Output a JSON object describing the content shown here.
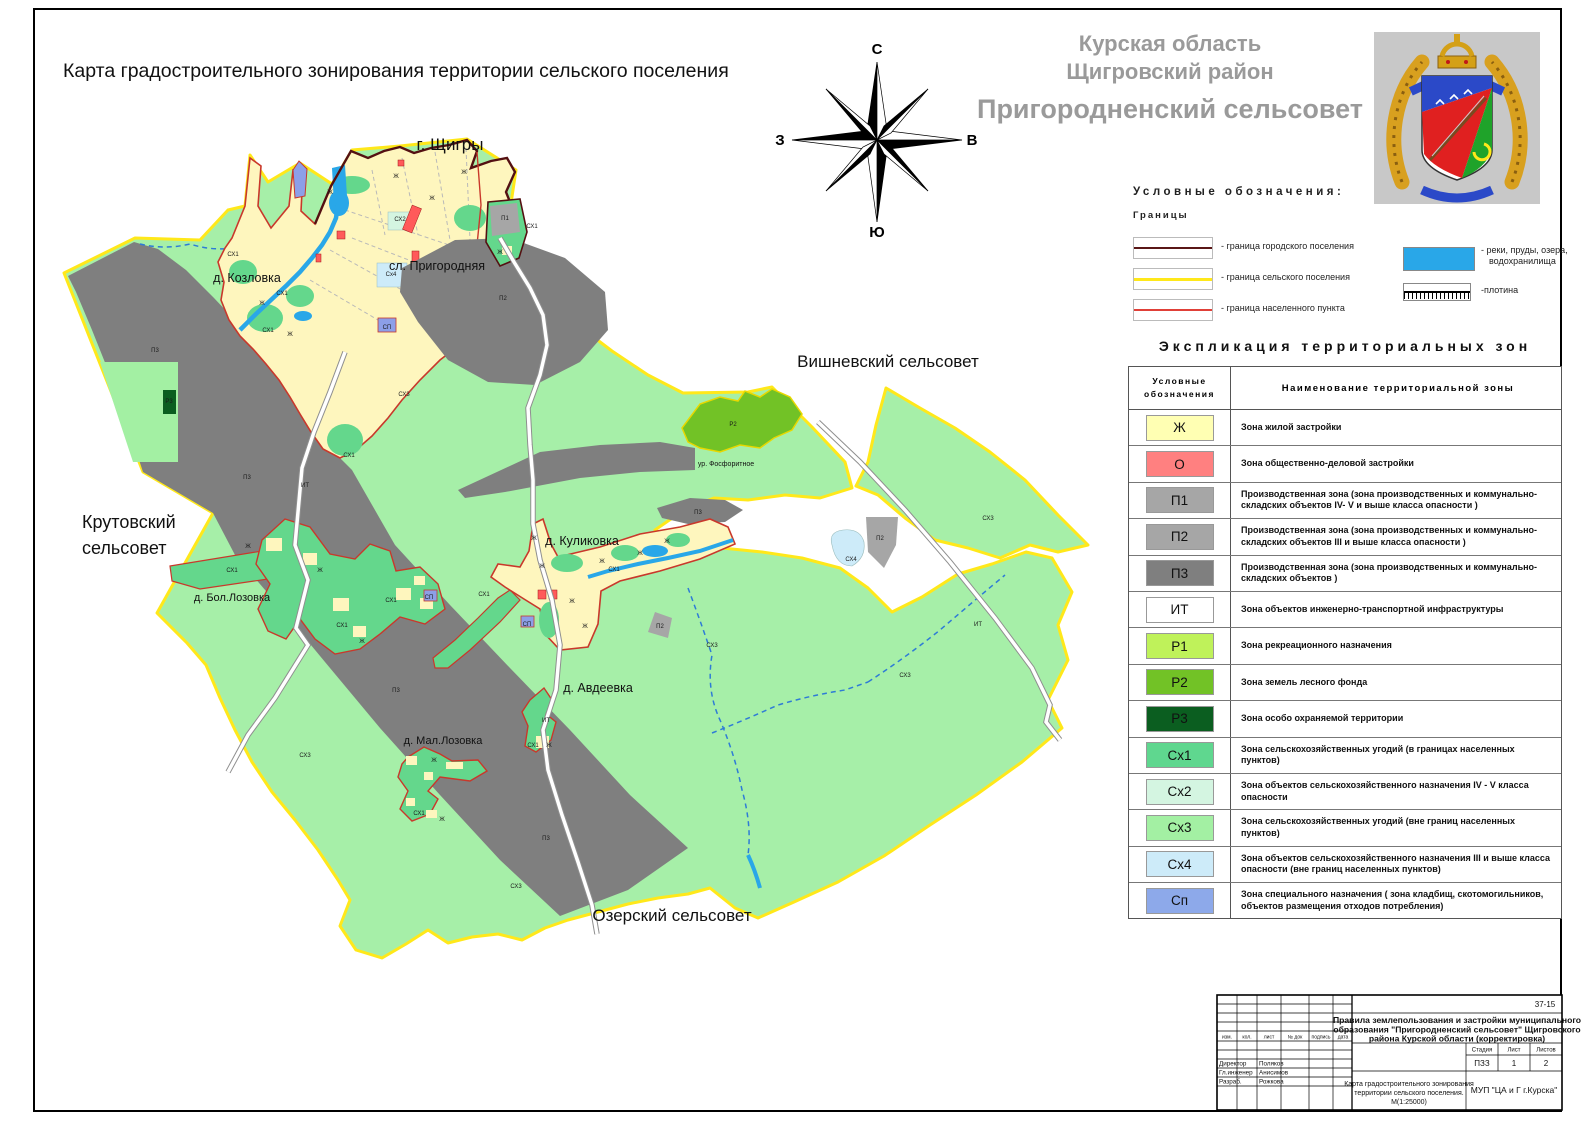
{
  "map": {
    "title": "Карта градостроительного зонирования территории сельского поселения",
    "labels": [
      {
        "t": "г. Щигры",
        "x": 450,
        "y": 150,
        "s": 17
      },
      {
        "t": "сл. Пригородняя",
        "x": 437,
        "y": 270,
        "s": 12.5
      },
      {
        "t": "д. Козловка",
        "x": 247,
        "y": 282,
        "s": 12.5
      },
      {
        "t": "Вишневский сельсовет",
        "x": 888,
        "y": 367,
        "s": 17
      },
      {
        "t": "Крутовский",
        "x": 82,
        "y": 528,
        "s": 18,
        "a": "start"
      },
      {
        "t": "сельсовет",
        "x": 82,
        "y": 554,
        "s": 18,
        "a": "start"
      },
      {
        "t": "д. Куликовка",
        "x": 582,
        "y": 545,
        "s": 12.5
      },
      {
        "t": "д. Бол.Лозовка",
        "x": 232,
        "y": 601,
        "s": 11
      },
      {
        "t": "д. Авдеевка",
        "x": 598,
        "y": 692,
        "s": 12.5
      },
      {
        "t": "д. Мал.Лозовка",
        "x": 443,
        "y": 744,
        "s": 11
      },
      {
        "t": "Озерский сельсовет",
        "x": 672,
        "y": 921,
        "s": 17
      },
      {
        "t": "ур. Фосфоритное",
        "x": 726,
        "y": 466,
        "s": 7
      }
    ],
    "zone_annotations": [
      {
        "t": "СХ1",
        "x": 233,
        "y": 256
      },
      {
        "t": "Ж",
        "x": 262,
        "y": 305
      },
      {
        "t": "СХ1",
        "x": 282,
        "y": 295
      },
      {
        "t": "СХ1",
        "x": 268,
        "y": 332
      },
      {
        "t": "Ж",
        "x": 290,
        "y": 336
      },
      {
        "t": "П3",
        "x": 155,
        "y": 352
      },
      {
        "t": "Р3",
        "x": 169,
        "y": 403
      },
      {
        "t": "П3",
        "x": 247,
        "y": 479
      },
      {
        "t": "ИТ",
        "x": 305,
        "y": 487
      },
      {
        "t": "СХ3",
        "x": 404,
        "y": 396
      },
      {
        "t": "СХ2",
        "x": 400,
        "y": 221
      },
      {
        "t": "Сх4",
        "x": 391,
        "y": 276
      },
      {
        "t": "Ж",
        "x": 330,
        "y": 194
      },
      {
        "t": "Ж",
        "x": 396,
        "y": 178
      },
      {
        "t": "Ж",
        "x": 432,
        "y": 200
      },
      {
        "t": "Ж",
        "x": 464,
        "y": 174
      },
      {
        "t": "Ж",
        "x": 500,
        "y": 254
      },
      {
        "t": "П1",
        "x": 505,
        "y": 220
      },
      {
        "t": "СХ1",
        "x": 532,
        "y": 228
      },
      {
        "t": "СП",
        "x": 387,
        "y": 329
      },
      {
        "t": "СХ1",
        "x": 349,
        "y": 457
      },
      {
        "t": "П2",
        "x": 503,
        "y": 300
      },
      {
        "t": "Р2",
        "x": 733,
        "y": 426
      },
      {
        "t": "П3",
        "x": 698,
        "y": 514
      },
      {
        "t": "П2",
        "x": 660,
        "y": 628
      },
      {
        "t": "П2",
        "x": 880,
        "y": 540
      },
      {
        "t": "СХ4",
        "x": 851,
        "y": 561
      },
      {
        "t": "ИТ",
        "x": 978,
        "y": 626
      },
      {
        "t": "СХ3",
        "x": 988,
        "y": 520
      },
      {
        "t": "СХ3",
        "x": 905,
        "y": 677
      },
      {
        "t": "СХ3",
        "x": 712,
        "y": 647
      },
      {
        "t": "Ж",
        "x": 248,
        "y": 548
      },
      {
        "t": "СХ1",
        "x": 232,
        "y": 572
      },
      {
        "t": "СХ1",
        "x": 342,
        "y": 627
      },
      {
        "t": "Ж",
        "x": 362,
        "y": 643
      },
      {
        "t": "СХ1",
        "x": 391,
        "y": 602
      },
      {
        "t": "СП",
        "x": 429,
        "y": 599
      },
      {
        "t": "Ж",
        "x": 320,
        "y": 572
      },
      {
        "t": "СХ3",
        "x": 305,
        "y": 757
      },
      {
        "t": "П3",
        "x": 396,
        "y": 692
      },
      {
        "t": "Ж",
        "x": 434,
        "y": 762
      },
      {
        "t": "СХ1",
        "x": 419,
        "y": 815
      },
      {
        "t": "Ж",
        "x": 442,
        "y": 821
      },
      {
        "t": "СХ1",
        "x": 533,
        "y": 747
      },
      {
        "t": "Ж",
        "x": 549,
        "y": 747
      },
      {
        "t": "ИТ",
        "x": 546,
        "y": 722
      },
      {
        "t": "СХ3",
        "x": 516,
        "y": 888
      },
      {
        "t": "П3",
        "x": 546,
        "y": 840
      },
      {
        "t": "Ж",
        "x": 534,
        "y": 540
      },
      {
        "t": "Ж",
        "x": 542,
        "y": 568
      },
      {
        "t": "Ж",
        "x": 572,
        "y": 603
      },
      {
        "t": "Ж",
        "x": 585,
        "y": 628
      },
      {
        "t": "СП",
        "x": 527,
        "y": 626
      },
      {
        "t": "Ж",
        "x": 602,
        "y": 563
      },
      {
        "t": "Ж",
        "x": 640,
        "y": 555
      },
      {
        "t": "Ж",
        "x": 667,
        "y": 543
      },
      {
        "t": "СХ1",
        "x": 484,
        "y": 596
      },
      {
        "t": "СХ1",
        "x": 614,
        "y": 571
      }
    ],
    "colors": {
      "territory_fill": "#A6EFA8",
      "boundary_settlement": "#FFE81A",
      "boundary_town": "#541012",
      "boundary_locality": "#C9382B",
      "water": "#29A7E8",
      "industrial_dark": "#7F7F7F",
      "industrial_mid": "#A6A6A6",
      "residential": "#FEF6BE",
      "agri_inner": "#64D78C",
      "forest": "#72C226"
    }
  },
  "compass": {
    "north": "С",
    "south": "Ю",
    "west": "З",
    "east": "В"
  },
  "header": {
    "region": "Курская область",
    "district": "Щигровский район",
    "settlement": "Пригородненский сельсовет"
  },
  "legend": {
    "title": "Условные обозначения:",
    "subtitle": "Границы",
    "boundary_items": [
      {
        "label": "- граница городского поселения",
        "color": "#5A1616",
        "thick": 2
      },
      {
        "label": "- граница сельского поселения",
        "color": "#FFE81A",
        "thick": 3
      },
      {
        "label": "- граница населенного пункта",
        "color": "#E04038",
        "thick": 2
      }
    ],
    "water_label_line1": "- реки, пруды, озера,",
    "water_label_line2": "водохранилища",
    "water_color": "#29A7E8",
    "dam_label": "-плотина"
  },
  "zones": {
    "title": "Экспликация территориальных зон",
    "col1_line1": "Условные",
    "col1_line2": "обозначения",
    "col2": "Наименование территориальной зоны",
    "rows": [
      {
        "code": "Ж",
        "color": "#FFFFB3",
        "desc": "Зона  жилой застройки"
      },
      {
        "code": "О",
        "color": "#FF8080",
        "desc": "Зона общественно-деловой застройки"
      },
      {
        "code": "П1",
        "color": "#A6A6A6",
        "desc": "Производственная зона (зона производственных и коммунально-складских объектов IV- V  и выше класса опасности )"
      },
      {
        "code": "П2",
        "color": "#A6A6A6",
        "desc": "Производственная зона  (зона производственных и коммунально-складских объектов III  и выше класса опасности )"
      },
      {
        "code": "П3",
        "color": "#7F7F7F",
        "desc": "Производственная зона  (зона производственных и коммунально-складских объектов  )"
      },
      {
        "code": "ИТ",
        "color": "#FFFFFF",
        "desc": "Зона объектов инженерно-транспортной  инфраструктуры"
      },
      {
        "code": "Р1",
        "color": "#BFF25A",
        "desc": "Зона рекреационного назначения"
      },
      {
        "code": "Р2",
        "color": "#72C226",
        "desc": "Зона земель лесного фонда"
      },
      {
        "code": "Р3",
        "color": "#0B5E20",
        "desc": "Зона особо охраняемой территории"
      },
      {
        "code": "Сх1",
        "color": "#5FD78F",
        "desc": "Зона  сельскохозяйственных угодий (в границах  населенных пунктов)"
      },
      {
        "code": "Сх2",
        "color": "#D4F5E1",
        "desc": "Зона объектов сельскохозяйственного  назначения IV - V класса  опасности"
      },
      {
        "code": "Сх3",
        "color": "#A3F0A3",
        "desc": "Зона  сельскохозяйственных  угодий (вне границ населенных пунктов)"
      },
      {
        "code": "Сх4",
        "color": "#CDEBF9",
        "desc": "Зона объектов сельскохозяйственного  назначения III и выше  класса опасности (вне границ населенных пунктов)"
      },
      {
        "code": "Сп",
        "color": "#8DA9EA",
        "desc": "Зона специального назначения ( зона кладбищ, скотомогильников,  объектов размещения отходов потребления)"
      }
    ]
  },
  "title_block": {
    "doc_number": "37-15",
    "doc_title_line1": "Правила землепользования и застройки муниципального",
    "doc_title_line2": "образования \"Пригородненский  сельсовет\" Щигровского",
    "doc_title_line3": "района Курской области (корректировка)",
    "stage_header": "Стадия",
    "sheet_header": "Лист",
    "sheets_header": "Листов",
    "stage_value": "ПЗЗ",
    "sheet_value": "1",
    "sheets_value": "2",
    "row_headers": [
      "изм.",
      "кол.",
      "лист",
      "№ док",
      "подпись",
      "дата"
    ],
    "signers": [
      {
        "role": "Директор",
        "name": "Поляков"
      },
      {
        "role": "Гл.инженер",
        "name": "Анисимов"
      },
      {
        "role": "Разраб.",
        "name": "Рожкова"
      }
    ],
    "drawing_name_line1": "Карта градостроительного зонирования",
    "drawing_name_line2": "территории сельского поселения.",
    "drawing_name_line3": "М(1:25000)",
    "organization": "МУП \"ЦА и Г г.Курска\""
  }
}
